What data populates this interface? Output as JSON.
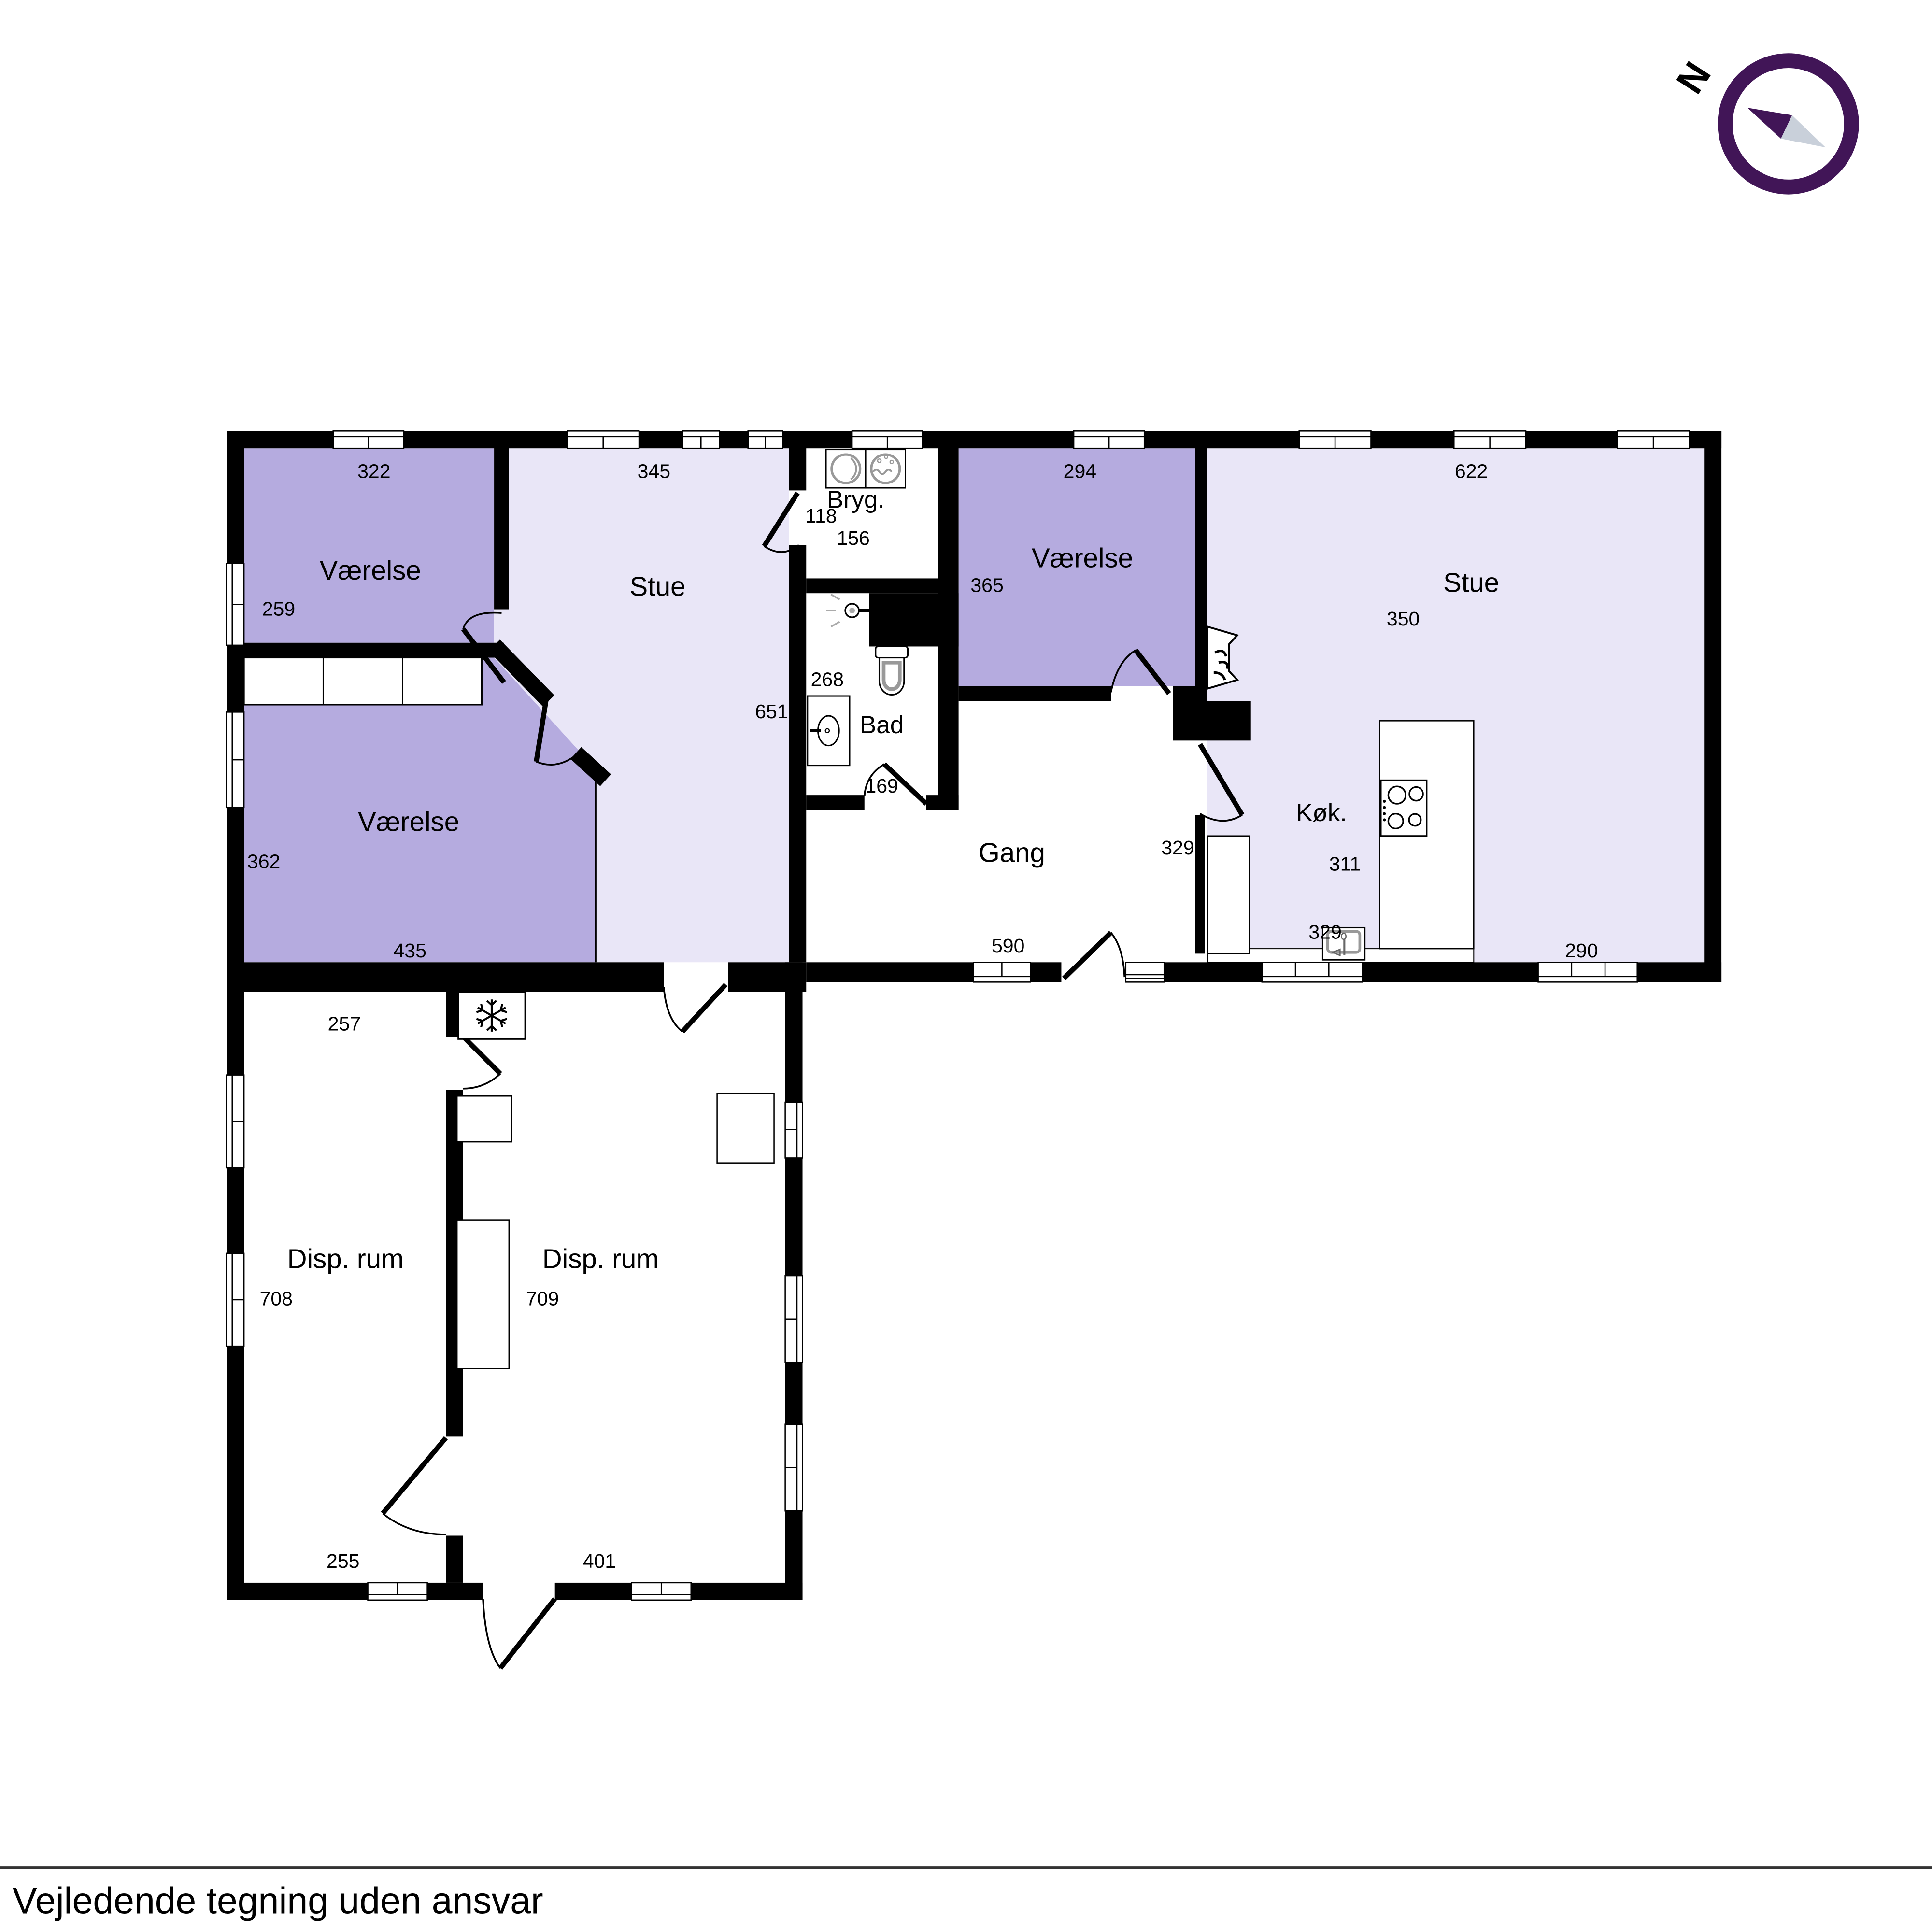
{
  "footer": {
    "disclaimer": "Vejledende tegning uden ansvar"
  },
  "compass": {
    "north_label": "N"
  },
  "colors": {
    "wall": "#000000",
    "room_purple": "#b5abdf",
    "room_lilac": "#e9e6f7",
    "room_white": "#ffffff",
    "compass_purple": "#411557",
    "compass_gray": "#c9d0da",
    "icon_gray": "#999999"
  },
  "rooms": {
    "vaerelse_nw": {
      "name": "Værelse",
      "width": "322",
      "height": "259"
    },
    "stue_left": {
      "name": "Stue",
      "width": "345",
      "height": "651"
    },
    "vaerelse_w": {
      "name": "Værelse",
      "width": "435",
      "height": "362"
    },
    "bryg": {
      "name": "Bryg.",
      "height": "118",
      "width": "156"
    },
    "bad": {
      "name": "Bad",
      "height": "268",
      "door": "169"
    },
    "vaerelse_mid": {
      "name": "Værelse",
      "width": "294",
      "height": "365"
    },
    "stue_right": {
      "name": "Stue",
      "width": "622",
      "height": "350",
      "width_b": "290"
    },
    "koek": {
      "name": "Køk.",
      "width": "311",
      "depth": "329",
      "wall": "329"
    },
    "gang": {
      "name": "Gang",
      "width": "590"
    },
    "disp_left": {
      "name": "Disp. rum",
      "height": "708",
      "top": "257",
      "bottom": "255"
    },
    "disp_right": {
      "name": "Disp. rum",
      "height": "709",
      "bottom": "401"
    }
  },
  "icons": [
    "compass-icon",
    "tumble-dryer-icon",
    "washing-machine-icon",
    "shower-icon",
    "toilet-icon",
    "bathroom-sink-icon",
    "fireplace-icon",
    "stove-icon",
    "kitchen-sink-icon",
    "freezer-icon"
  ]
}
